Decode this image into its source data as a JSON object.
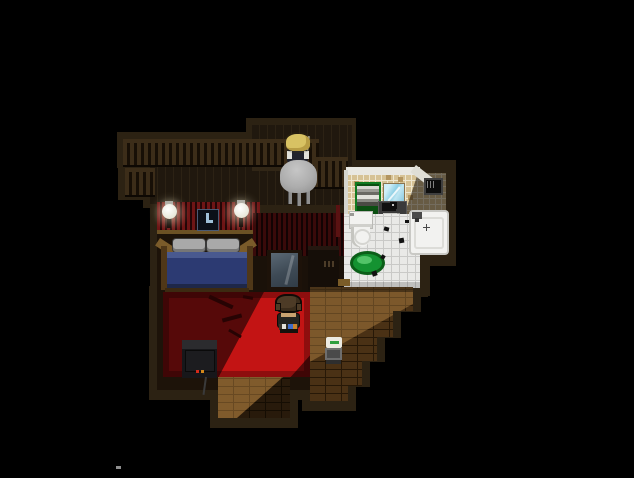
{
  "app": {
    "name": "pixel-rpg-house-interior",
    "view": "top-down pixel-art room scene at night"
  },
  "palette": {
    "black": "#000000",
    "border": "#2c2213",
    "wood-wall": "#20180e",
    "wood-line": "#2c2214",
    "railing": "#3c2d19",
    "railing-dark": "#170f06",
    "wallpaper": "#6e1515",
    "wallpaper-stripe": "#230606",
    "trim": "#6b5124",
    "floor-dark": "#1d1309",
    "brick": "#4a3115",
    "brick-line": "#271807",
    "carpet-dark": "#560909",
    "carpet-dark-edge": "#3f0606",
    "carpet-lit": "#c31414",
    "carpet-lit-edge": "#8e0e0e",
    "tile-wall": "#d6c295",
    "tile-grout": "#efe7cf",
    "tile-dark": "#b3955f",
    "bath-floor": "#e9e9e7",
    "bath-grout": "#c9c9c7",
    "porcelain": "#f2f2f0",
    "mat-green": "#149231",
    "mat-green-dark": "#0b5e18",
    "mat-green-light": "#52c468",
    "shelf-green": "#0f7a20",
    "mirror-blue": "#9dd8ec",
    "metal": "#b9b9b9",
    "skin": "#c9a270",
    "hair-blonde": "#d8c263",
    "hair-brown": "#4d3b26",
    "blanket": "#2c3a72",
    "blanket-light": "#49598f",
    "pillow": "#a9a9a9",
    "tv": "#17171a",
    "led-red": "#d42a1a",
    "led-orange": "#d4881a"
  },
  "scene": {
    "rooms": [
      {
        "name": "balcony-lounge",
        "objects": [
          "wood-railing",
          "round-gray-table",
          "seated-blonde-npc",
          "plank-wall"
        ]
      },
      {
        "name": "bedroom",
        "objects": [
          "striped-red-wallpaper",
          "wall-lamp-left",
          "wall-lamp-right",
          "wall-clock",
          "double-bed",
          "standing-mirror",
          "dark-wardrobe",
          "red-carpet",
          "tv-set"
        ]
      },
      {
        "name": "bathroom",
        "objects": [
          "tan-tile-wall",
          "towel-shelf",
          "bath-mirror",
          "sink",
          "toilet",
          "bathtub",
          "green-bath-mat",
          "wall-vent",
          "dirt-stains"
        ]
      },
      {
        "name": "hallway",
        "objects": [
          "stepped-brick-floor",
          "small-radio",
          "threshold"
        ]
      }
    ],
    "characters": [
      {
        "name": "player",
        "hair": "brown",
        "outfit": "dark shirt with white-blue-orange belt",
        "position": "standing on red carpet",
        "facing": "down"
      },
      {
        "name": "npc",
        "hair": "blonde",
        "outfit": "dark overalls over white shirt",
        "position": "seated at round table on balcony"
      }
    ],
    "lighting": "diagonal light shaft from upper right illuminating bathroom, brick hallway and lower half of red carpet; rest of house in deep shadow"
  }
}
